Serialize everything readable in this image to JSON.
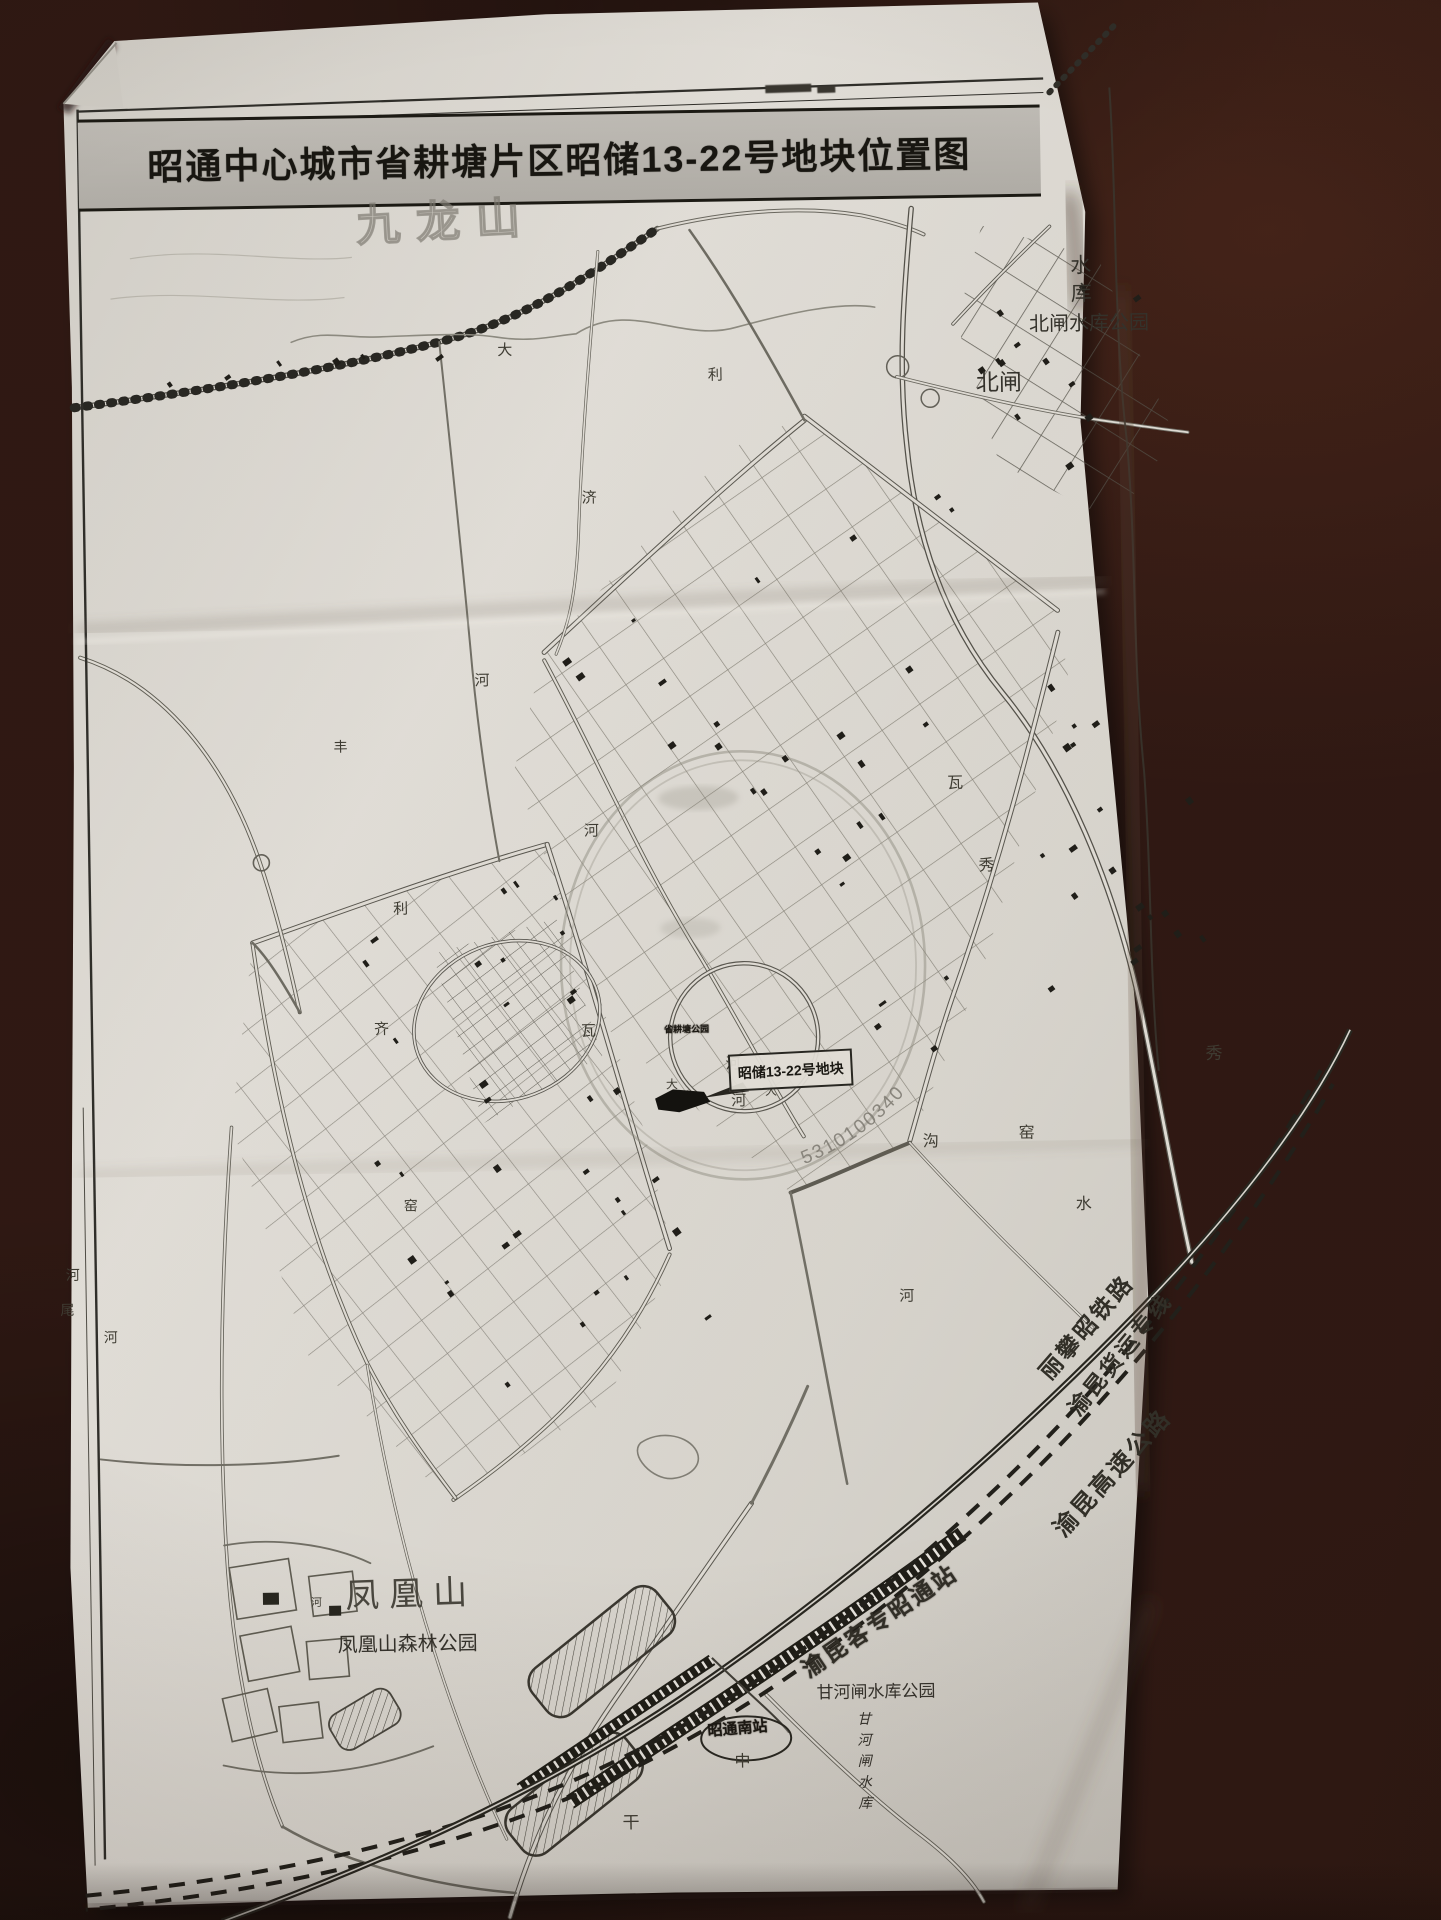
{
  "scene": {
    "desk_color": "#2a130e",
    "paper_color": "#d9d6cf",
    "titlebar_color": "#b7b4ae"
  },
  "title": {
    "text": "昭通中心城市省耕塘片区昭储13-22号地块位置图"
  },
  "callout": {
    "label": "昭储13-22号地块"
  },
  "stamp": {
    "digits": "5310100340"
  },
  "map": {
    "labels": [
      {
        "id": "hill-label",
        "text": "九龙山",
        "x": 366,
        "y": 200,
        "size": 44,
        "rot": -2,
        "cls": "hollow"
      },
      {
        "id": "reservoir-label",
        "text": "水库",
        "x": 1078,
        "y": 262,
        "size": 21,
        "cls": "vert"
      },
      {
        "id": "beizha-park-label",
        "text": "北闸水库公园",
        "x": 1038,
        "y": 322,
        "size": 20,
        "cls": ""
      },
      {
        "id": "beizha-label",
        "text": "北闸",
        "x": 984,
        "y": 378,
        "size": 23,
        "cls": ""
      },
      {
        "id": "road-char",
        "text": "大",
        "x": 506,
        "y": 342,
        "size": 15,
        "cls": "rd"
      },
      {
        "id": "road-char",
        "text": "利",
        "x": 716,
        "y": 370,
        "size": 15,
        "cls": "rd"
      },
      {
        "id": "road-char",
        "text": "济",
        "x": 588,
        "y": 491,
        "size": 15,
        "cls": "rd"
      },
      {
        "id": "road-char",
        "text": "河",
        "x": 478,
        "y": 672,
        "size": 15,
        "cls": "rd"
      },
      {
        "id": "road-char",
        "text": "丰",
        "x": 336,
        "y": 737,
        "size": 14,
        "cls": "rd"
      },
      {
        "id": "road-char",
        "text": "河",
        "x": 585,
        "y": 824,
        "size": 15,
        "cls": "rd"
      },
      {
        "id": "road-char",
        "text": "利",
        "x": 393,
        "y": 899,
        "size": 15,
        "cls": "rd"
      },
      {
        "id": "road-char",
        "text": "齐",
        "x": 372,
        "y": 1019,
        "size": 15,
        "cls": "rd"
      },
      {
        "id": "road-char",
        "text": "瓦",
        "x": 579,
        "y": 1024,
        "size": 15,
        "cls": "rd"
      },
      {
        "id": "road-char",
        "text": "河",
        "x": 723,
        "y": 1059,
        "size": 15,
        "cls": "rd"
      },
      {
        "id": "road-char",
        "text": "河",
        "x": 728,
        "y": 1096,
        "size": 15,
        "cls": "rd"
      },
      {
        "id": "road-char",
        "text": "瓦",
        "x": 949,
        "y": 781,
        "size": 16,
        "cls": "rd"
      },
      {
        "id": "road-char",
        "text": "秀",
        "x": 979,
        "y": 864,
        "size": 16,
        "cls": "rd"
      },
      {
        "id": "road-char",
        "text": "沟",
        "x": 919,
        "y": 1139,
        "size": 16,
        "cls": "rd"
      },
      {
        "id": "road-char",
        "text": "窑",
        "x": 1015,
        "y": 1132,
        "size": 16,
        "cls": "rd"
      },
      {
        "id": "road-char",
        "text": "水",
        "x": 1071,
        "y": 1204,
        "size": 16,
        "cls": "rd"
      },
      {
        "id": "road-char",
        "text": "秀",
        "x": 1203,
        "y": 1055,
        "size": 17,
        "cls": "rd"
      },
      {
        "id": "road-char",
        "text": "河",
        "x": 893,
        "y": 1294,
        "size": 15,
        "cls": "rd"
      },
      {
        "id": "road-char",
        "text": "窑",
        "x": 399,
        "y": 1197,
        "size": 14,
        "cls": "rd"
      },
      {
        "id": "river-char",
        "text": "河",
        "x": 60,
        "y": 1261,
        "size": 14,
        "cls": "rd"
      },
      {
        "id": "river-char",
        "text": "尾",
        "x": 54,
        "y": 1296,
        "size": 14,
        "cls": "rd"
      },
      {
        "id": "river-char",
        "text": "河",
        "x": 97,
        "y": 1324,
        "size": 14,
        "cls": "rd"
      },
      {
        "id": "road-char",
        "text": "大",
        "x": 663,
        "y": 1080,
        "size": 12,
        "cls": "rd"
      },
      {
        "id": "road-char",
        "text": "大",
        "x": 762,
        "y": 1088,
        "size": 12,
        "cls": "rd"
      },
      {
        "id": "road-char",
        "text": "中",
        "x": 721,
        "y": 1756,
        "size": 16,
        "cls": "rd"
      },
      {
        "id": "road-char",
        "text": "干",
        "x": 608,
        "y": 1815,
        "size": 17,
        "cls": "rd"
      },
      {
        "id": "road-char",
        "text": "河",
        "x": 300,
        "y": 1594,
        "size": 11,
        "cls": "rd"
      },
      {
        "id": "shenggengtang-park-label",
        "text": "省耕塘公园",
        "x": 662,
        "y": 1027,
        "size": 9,
        "cls": "dark"
      },
      {
        "id": "fenghuangshan-label",
        "text": "凤凰山",
        "x": 334,
        "y": 1576,
        "size": 34,
        "rot": -1,
        "cls": "mtn"
      },
      {
        "id": "fenghuang-forest-park-label",
        "text": "凤凰山森林公园",
        "x": 326,
        "y": 1632,
        "size": 20,
        "cls": ""
      },
      {
        "id": "ganhezha-park-label",
        "text": "甘河闸水库公园",
        "x": 804,
        "y": 1688,
        "size": 17,
        "cls": ""
      },
      {
        "id": "ganhezha-reservoir-label",
        "text": "甘河闸水库",
        "x": 842,
        "y": 1716,
        "size": 14,
        "cls": "vert ital"
      },
      {
        "id": "station-south-label",
        "text": "昭通南站",
        "x": 694,
        "y": 1726,
        "size": 15,
        "rot": -4,
        "cls": "dark"
      },
      {
        "id": "lipanzhao-railway-label",
        "text": "丽攀昭铁路",
        "x": 1028,
        "y": 1376,
        "size": 23,
        "rot": -48,
        "cls": "rail"
      },
      {
        "id": "yukun-freight-label",
        "text": "渝昆货运专线",
        "x": 1056,
        "y": 1413,
        "size": 22,
        "rot": -50,
        "cls": "rail"
      },
      {
        "id": "yukun-expressway-label",
        "text": "渝昆高速公路",
        "x": 1040,
        "y": 1533,
        "size": 24,
        "rot": -47,
        "cls": "rail"
      },
      {
        "id": "yukun-station-label",
        "text": "渝昆客专昭通站",
        "x": 786,
        "y": 1666,
        "size": 23,
        "rot": -33,
        "cls": "dark rail"
      }
    ]
  }
}
